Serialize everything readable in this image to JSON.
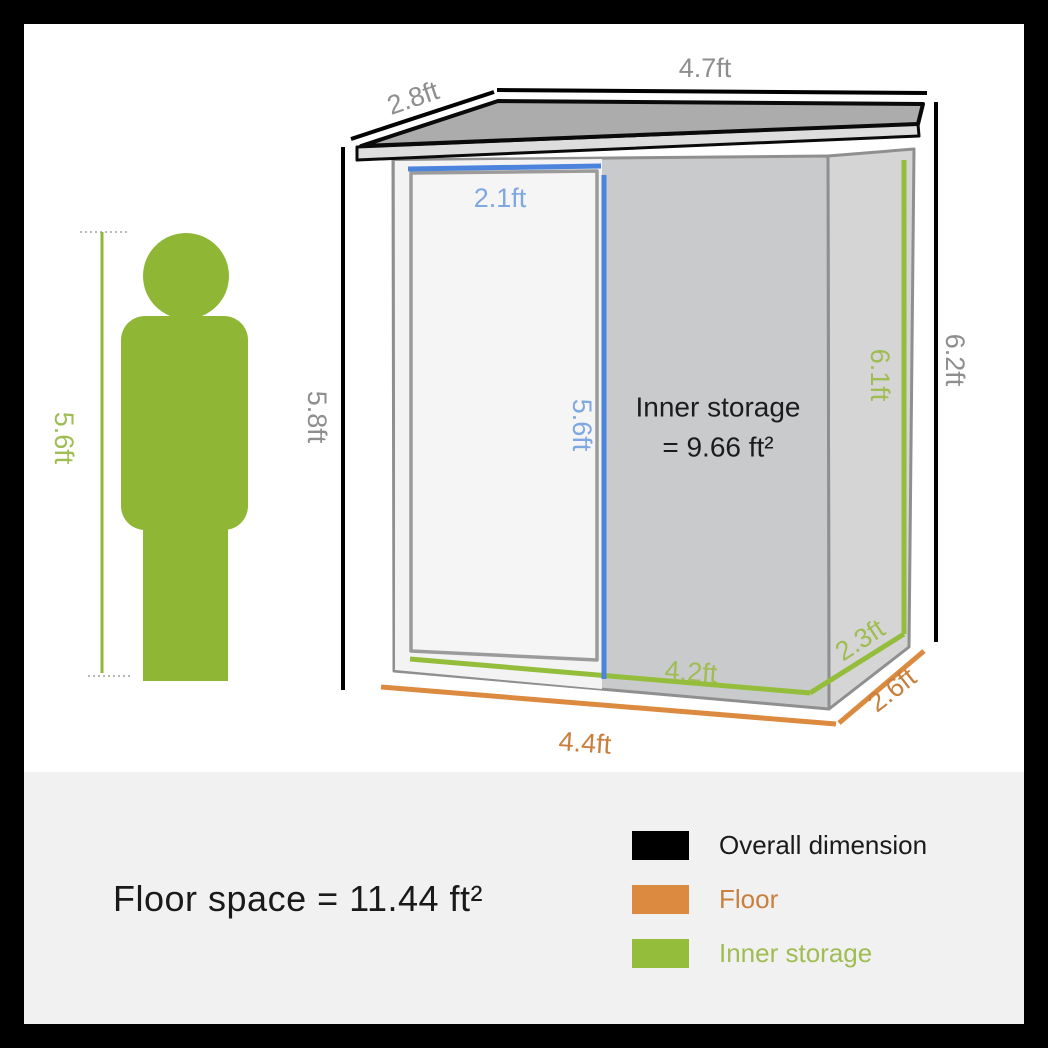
{
  "diagram": {
    "dimension_labels": {
      "roof_width": "4.7ft",
      "roof_depth": "2.8ft",
      "door_width": "2.1ft",
      "door_height": "5.6ft",
      "inner_height": "6.1ft",
      "overall_height": "6.2ft",
      "wall_height": "5.8ft",
      "person_height": "5.6ft",
      "inner_floor_width": "4.2ft",
      "inner_floor_depth": "2.3ft",
      "floor_depth": "2.6ft",
      "floor_width": "4.4ft"
    },
    "inner_storage_note": {
      "line1": "Inner storage",
      "line2": "= 9.66 ft²"
    },
    "colors": {
      "overall_dimension_black": "#000000",
      "floor_orange": "#db8a3f",
      "inner_storage_green": "#94bd3b",
      "door_accent_blue": "#4b83dd",
      "person_green": "#8fb735",
      "gray_label": "#8e8e8e",
      "blue_label": "#7fa8e0",
      "green_label": "#9fbd52",
      "orange_label": "#c97f3d",
      "legend_text_black": "#1b1b1b"
    }
  },
  "footer": {
    "floor_space_text": "Floor space = 11.44 ft²",
    "legend": [
      {
        "label": "Overall dimension"
      },
      {
        "label": "Floor"
      },
      {
        "label": "Inner storage"
      }
    ]
  }
}
